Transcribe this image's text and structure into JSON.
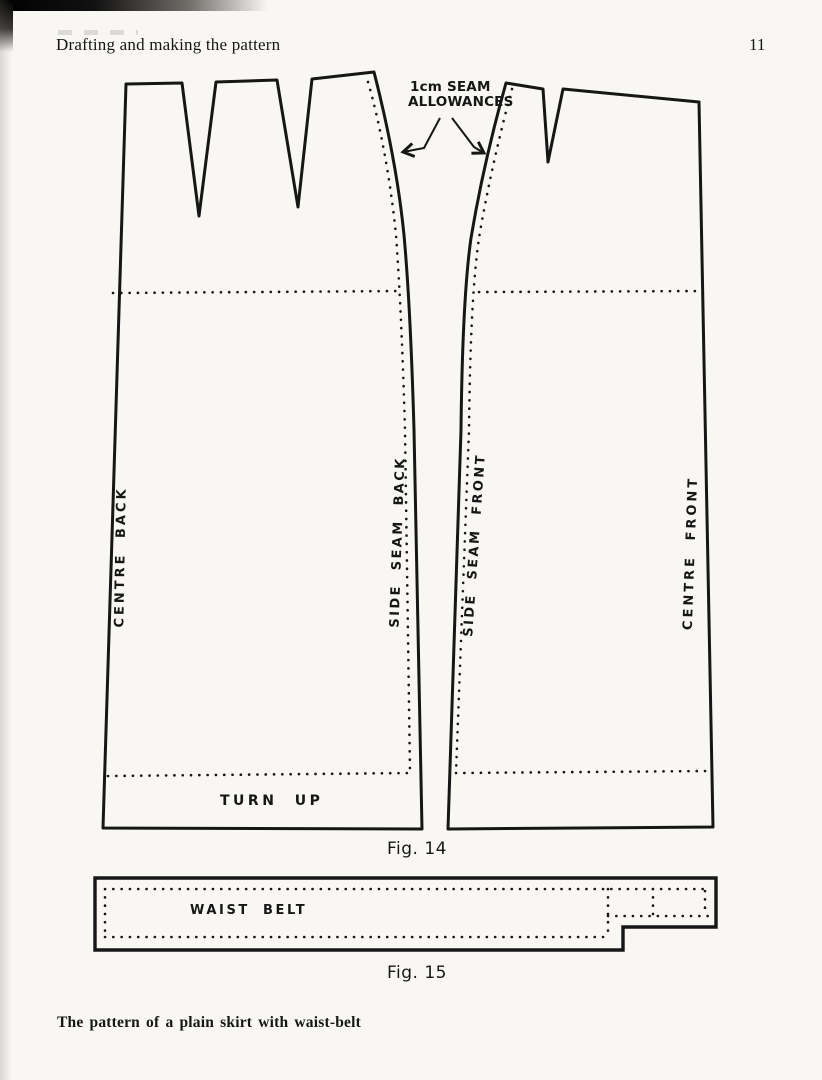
{
  "page": {
    "header_title": "Drafting and making the pattern",
    "page_number": "11",
    "footer_caption": "The pattern of a plain skirt with waist-belt"
  },
  "figure_14": {
    "caption": "Fig. 14",
    "seam_note_line1": "1cm SEAM",
    "seam_note_line2": "ALLOWANCES",
    "label_centre_back": "CENTRE BACK",
    "label_side_seam_back": "SIDE SEAM BACK",
    "label_side_seam_front": "SIDE SEAM FRONT",
    "label_centre_front": "CENTRE FRONT",
    "label_turn_up": "TURN UP"
  },
  "figure_15": {
    "caption": "Fig. 15",
    "label_waist_belt": "WAIST BELT"
  },
  "colors": {
    "ink": "#161616",
    "paper": "#f8f7f4"
  }
}
